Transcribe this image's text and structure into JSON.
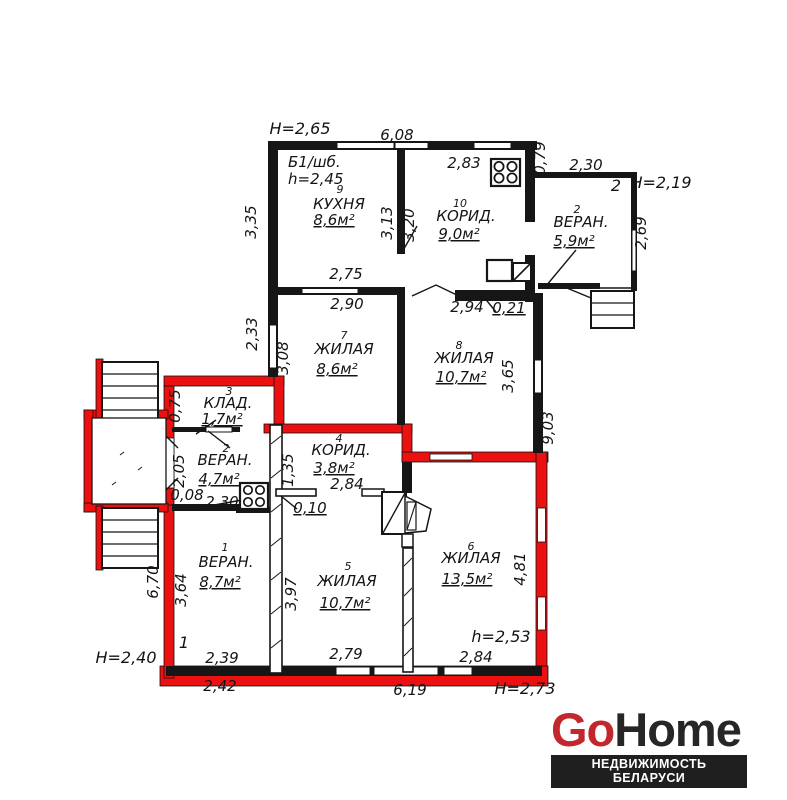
{
  "logo": {
    "go": "Go",
    "home": "Home",
    "tagline": "НЕДВИЖИМОСТЬ БЕЛАРУСИ",
    "go_color": "#c1272d",
    "text_color": "#262626",
    "tagline_bg": "#1f1f1f",
    "tagline_color": "#ffffff"
  },
  "plan": {
    "colors": {
      "wall": "#161616",
      "highlight": "#ec1111"
    },
    "annotations": {
      "building": "Б1/шб.",
      "height_top_left": "H=2,65",
      "ceiling_kitchen": "h=2,45",
      "height_top_right": "H=2,19",
      "height_bottom_left": "H=2,40",
      "ceiling_room6": "h=2,53",
      "height_bottom_right": "H=2,73",
      "part1": "1",
      "part2": "2"
    },
    "rooms": {
      "kitchen": {
        "num": "9",
        "name": "КУХНЯ",
        "area": "8,6м²"
      },
      "corridor10": {
        "num": "10",
        "name": "КОРИД.",
        "area": "9,0м²"
      },
      "veranda_tr": {
        "num": "2",
        "name": "ВЕРАН.",
        "area": "5,9м²"
      },
      "room7": {
        "num": "7",
        "name": "ЖИЛАЯ",
        "area": "8,6м²"
      },
      "room8": {
        "num": "8",
        "name": "ЖИЛАЯ",
        "area": "10,7м²"
      },
      "storage": {
        "num": "3",
        "name": "КЛАД.",
        "area": "1,7м²"
      },
      "veranda_ml": {
        "num": "2",
        "name": "ВЕРАН.",
        "area": "4,7м²"
      },
      "corridor4": {
        "num": "4",
        "name": "КОРИД.",
        "area": "3,8м²"
      },
      "room5": {
        "num": "5",
        "name": "ЖИЛАЯ",
        "area": "10,7м²"
      },
      "room6": {
        "num": "6",
        "name": "ЖИЛАЯ",
        "area": "13,5м²"
      },
      "veranda1": {
        "num": "1",
        "name": "ВЕРАН.",
        "area": "8,7м²"
      }
    },
    "dims": {
      "top_width": "6,08",
      "corr10_w": "2,83",
      "jog": "0,79",
      "ver_tr_w": "2,30",
      "ver_tr_h": "2,69",
      "kitchen_left": "3,35",
      "div_kitchen": "3,13",
      "div_corr": "3,20",
      "kitchen_bottom": "2,75",
      "room7_top": "2,90",
      "corr_bottom": "2,94",
      "wall_021": "0,21",
      "room7_left_out": "2,33",
      "room7_left_in": "3,08",
      "room8_right": "3,65",
      "right_total": "9,03",
      "storage_left": "0,75",
      "ver_ml_left": "2,05",
      "stub_008": "0,08",
      "ver_ml_bottom": "2,30",
      "corr4_left": "1,35",
      "stub_010": "0,10",
      "corr4_w": "2,84",
      "room5_left": "3,97",
      "room6_right": "4,81",
      "ver1_left_in": "3,64",
      "ver1_left_out": "6,70",
      "ver1_bottom_in": "2,39",
      "ver1_bottom_out": "2,42",
      "room5_bottom": "2,79",
      "room6_bottom": "2,84",
      "bottom_width": "6,19"
    }
  }
}
